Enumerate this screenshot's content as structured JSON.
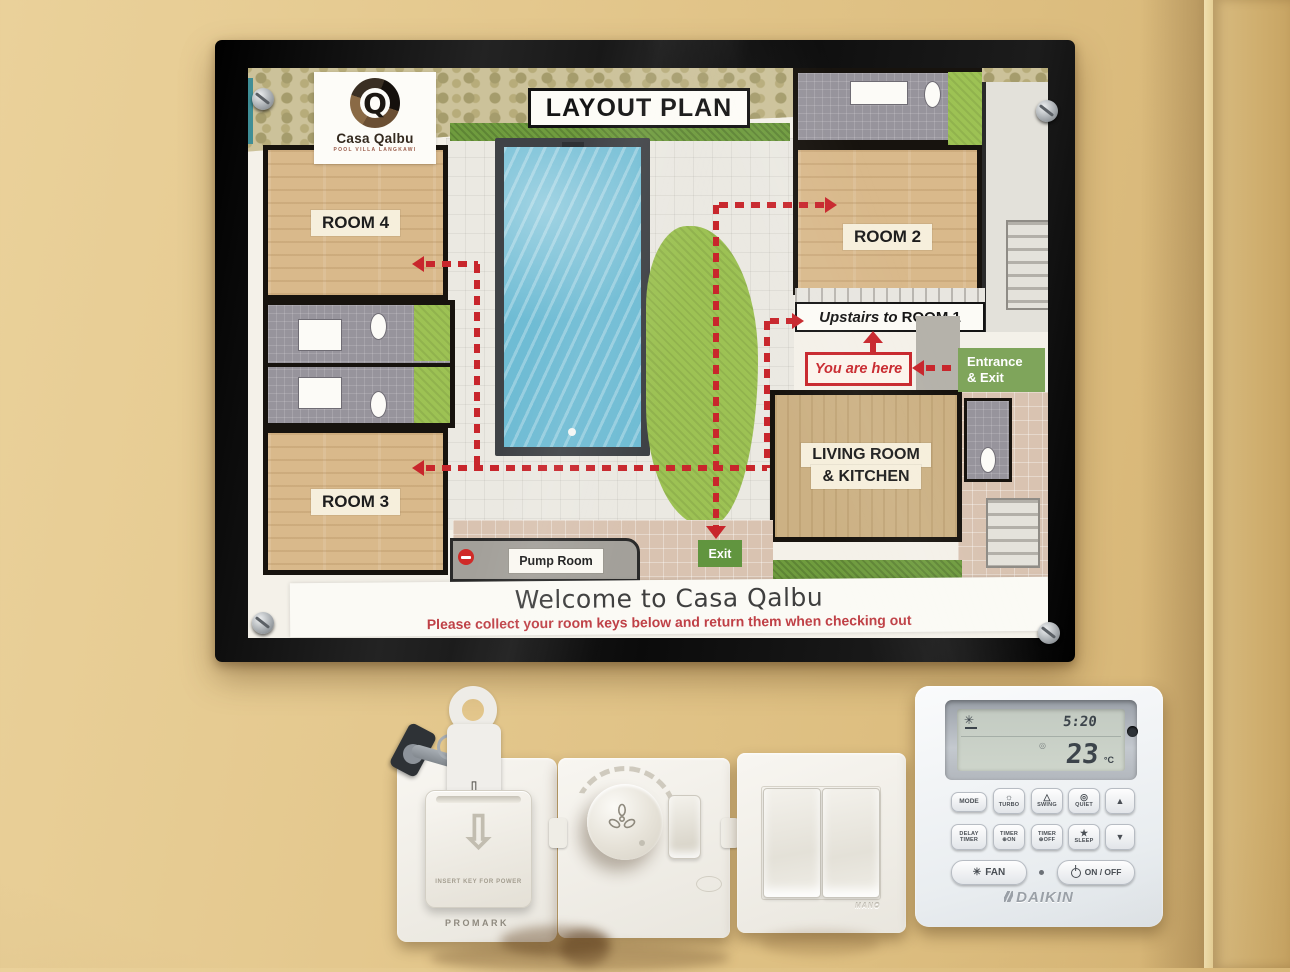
{
  "sign": {
    "logo": {
      "monogram": "Q",
      "name": "Casa Qalbu",
      "tagline": "POOL VILLA LANGKAWI"
    },
    "title": "LAYOUT PLAN",
    "rooms": {
      "room4": "ROOM 4",
      "room3": "ROOM 3",
      "room2": "ROOM 2",
      "room1_prefix": "Upstairs to",
      "room1": "ROOM 1",
      "living_line1": "LIVING ROOM",
      "living_line2": "& KITCHEN",
      "pump_room": "Pump Room"
    },
    "markers": {
      "you_are_here": "You are here",
      "entrance_line1": "Entrance",
      "entrance_line2": "& Exit",
      "exit": "Exit"
    },
    "footer": {
      "welcome": "Welcome to Casa Qalbu",
      "note": "Please collect your room keys below and return them when checking out"
    }
  },
  "devices": {
    "keycard_switch": {
      "instruction": "INSERT KEY FOR POWER",
      "brand": "PROMARK"
    },
    "light_switch": {
      "brand": "MANO"
    },
    "thermostat": {
      "brand": "DAIKIN",
      "lcd": {
        "time": "5:20",
        "temperature": "23",
        "unit": "°C"
      },
      "buttons": {
        "mode": "MODE",
        "turbo": "TURBO",
        "swing": "SWING",
        "quiet": "QUIET",
        "delay_line1": "DELAY",
        "delay_line2": "TIMER",
        "timer_on_line1": "TIMER",
        "timer_on_line2": "ON",
        "timer_off_line1": "TIMER",
        "timer_off_line2": "OFF",
        "sleep": "SLEEP",
        "fan": "FAN",
        "power": "ON / OFF"
      }
    }
  },
  "icons": {
    "turbo": "☼",
    "swing": "△",
    "quiet": "◎",
    "sleep": "★",
    "fan": "✳",
    "lcd_fan": "✳",
    "lcd_quiet": "◎",
    "up": "▲",
    "down": "▼",
    "clock": "⊕",
    "card_arrow": "⇩",
    "pocket_arrow": "⇩"
  },
  "colors": {
    "route_red": "#c8262c",
    "marker_green": "#7fa55b",
    "wall_tan": "#e4c88e",
    "frame_black": "#111111"
  }
}
